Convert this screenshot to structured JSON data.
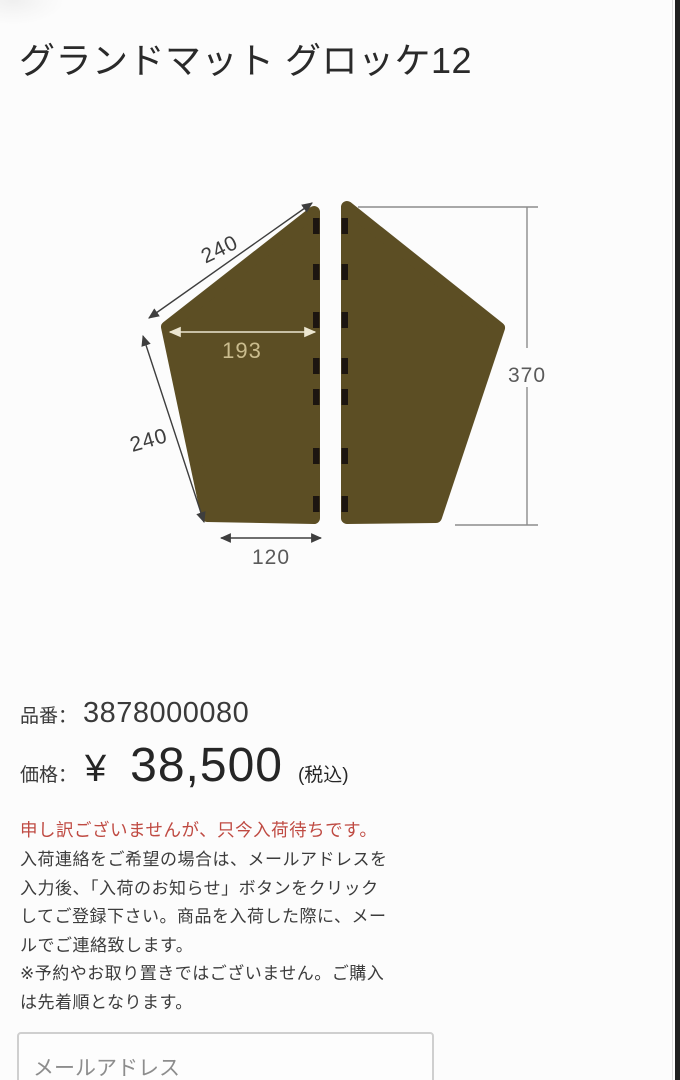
{
  "title": "グランドマット グロッケ12",
  "diagram": {
    "top_edge_dim": "240",
    "inner_width_dim": "193",
    "left_edge_dim": "240",
    "bottom_edge_dim": "120",
    "height_dim": "370",
    "mat_color": "#5c4e24",
    "tab_color": "#1c1510",
    "dim_dark_color": "#3e3e3e",
    "dim_gray_color": "#8c8c8c",
    "dim_cream_color": "#ece6d0",
    "dim_tan_text_color": "#cabc8e"
  },
  "product": {
    "code_label": "品番：",
    "code": "3878000080",
    "price_label": "価格：",
    "currency": "¥",
    "price": "38,500",
    "tax_note": "(税込)"
  },
  "stock": {
    "alert": "申し訳ございませんが、只今入荷待ちです。",
    "alert_color": "#bf4a42",
    "description": "入荷連絡をご希望の場合は、メールアドレスを\n入力後、「入荷のお知らせ」ボタンをクリック\nしてご登録下さい。商品を入荷した際に、メー\nルでご連絡致します。",
    "note": "※予約やお取り置きではございません。ご購入\nは先着順となります。"
  },
  "form": {
    "email_placeholder": "メールアドレス"
  }
}
